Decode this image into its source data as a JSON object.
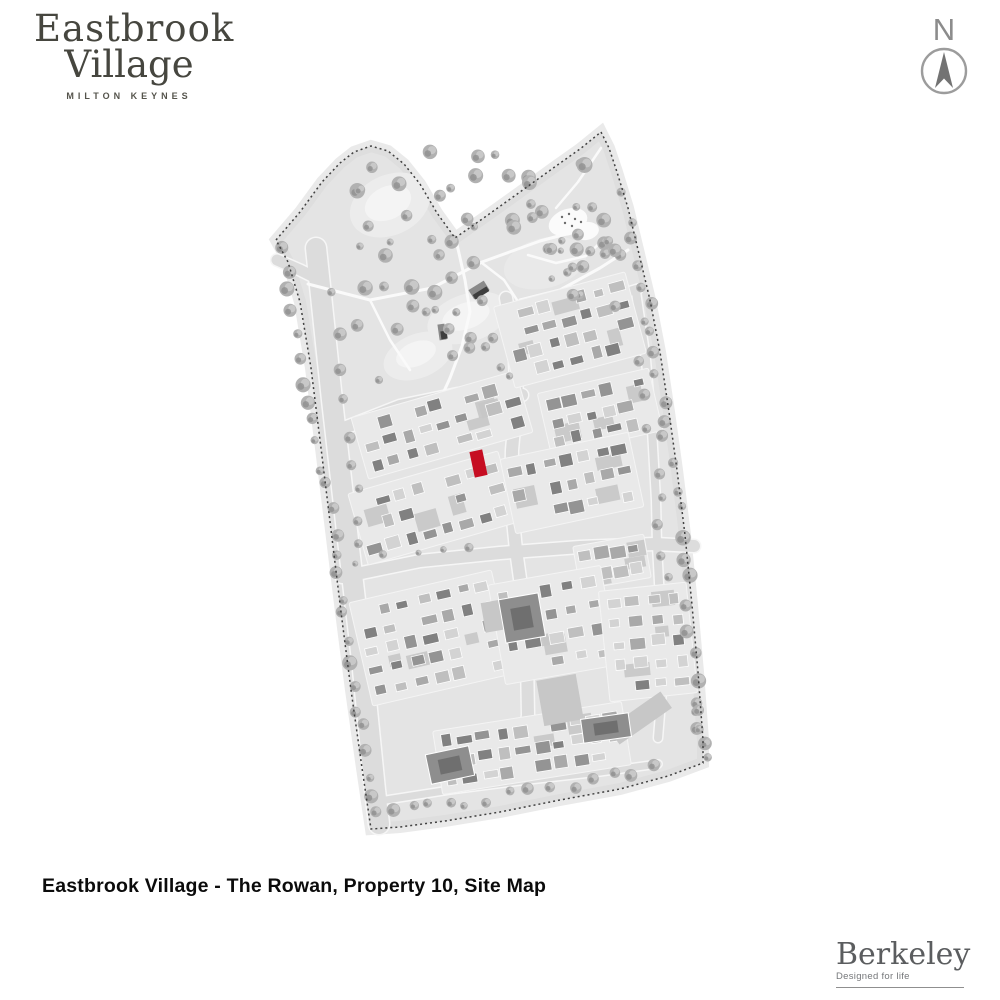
{
  "branding": {
    "site_logo": {
      "line1": "Eastbrook",
      "line2": "Village",
      "subtitle": "MILTON KEYNES",
      "color": "#46463f"
    },
    "developer_logo": {
      "name": "Berkeley",
      "tagline": "Designed for life",
      "color": "#5b5d5f"
    }
  },
  "compass": {
    "label": "N",
    "color": "#8c8c8c"
  },
  "caption": {
    "text": "Eastbrook Village - The Rowan, Property 10, Site Map"
  },
  "map": {
    "seed": 20231007,
    "colors": {
      "land": "#e4e4e4",
      "land_edge": "#d9d9d9",
      "road": "#dcdcdc",
      "road_casing": "#f6f6f6",
      "footpath": "#fafafa",
      "pond": "#ececec",
      "pond_inner": "#f4f4f4",
      "boundary": "#404040",
      "house_palette": [
        "#818181",
        "#949494",
        "#a9a9a9",
        "#bfbfbf",
        "#d3d3d3"
      ],
      "house_stroke": "#ffffff",
      "block_base": "#e9e9e9",
      "driveway": "#c7c7c7",
      "big_building": "#8e8e8e",
      "big_building_dark": "#6f6f6f",
      "tree_base": "#b1b1b1",
      "tree_light": "#cbcbcb",
      "tree_dark": "#909090",
      "bridge_dark": "#3e3e3e",
      "bridge_mid": "#8a8a8a",
      "play_area": "#fbfbfb",
      "highlight": "#c60d22"
    },
    "boundary_points": [
      [
        601,
        132
      ],
      [
        609,
        148
      ],
      [
        617,
        172
      ],
      [
        628,
        208
      ],
      [
        640,
        258
      ],
      [
        650,
        300
      ],
      [
        660,
        352
      ],
      [
        669,
        412
      ],
      [
        677,
        470
      ],
      [
        685,
        535
      ],
      [
        692,
        605
      ],
      [
        698,
        672
      ],
      [
        703,
        740
      ],
      [
        703,
        763
      ],
      [
        668,
        776
      ],
      [
        620,
        789
      ],
      [
        560,
        800
      ],
      [
        500,
        812
      ],
      [
        445,
        821
      ],
      [
        400,
        827
      ],
      [
        371,
        829
      ],
      [
        362,
        768
      ],
      [
        351,
        690
      ],
      [
        341,
        612
      ],
      [
        331,
        530
      ],
      [
        321,
        448
      ],
      [
        311,
        368
      ],
      [
        300,
        302
      ],
      [
        288,
        262
      ],
      [
        276,
        240
      ],
      [
        300,
        212
      ],
      [
        322,
        182
      ],
      [
        340,
        163
      ],
      [
        354,
        152
      ],
      [
        371,
        146
      ],
      [
        388,
        151
      ],
      [
        404,
        164
      ],
      [
        420,
        184
      ],
      [
        437,
        213
      ],
      [
        455,
        238
      ],
      [
        485,
        217
      ],
      [
        520,
        192
      ],
      [
        556,
        166
      ],
      [
        580,
        149
      ],
      [
        601,
        132
      ]
    ],
    "ponds": [
      [
        390,
        205,
        42,
        30,
        -25
      ],
      [
        468,
        318,
        42,
        24,
        -18
      ],
      [
        418,
        356,
        36,
        22,
        -22
      ]
    ],
    "park_ovals": [
      [
        545,
        263,
        42,
        25,
        -15
      ],
      [
        395,
        215,
        24,
        15,
        -25
      ]
    ],
    "roads": [
      {
        "pts": [
          [
            316,
            248
          ],
          [
            332,
            400
          ],
          [
            348,
            540
          ],
          [
            362,
            660
          ],
          [
            375,
            790
          ],
          [
            379,
            824
          ]
        ],
        "w": 20
      },
      {
        "pts": [
          [
            277,
            260
          ],
          [
            300,
            270
          ],
          [
            320,
            280
          ]
        ],
        "w": 11
      },
      {
        "pts": [
          [
            344,
            428
          ],
          [
            400,
            406
          ],
          [
            458,
            394
          ],
          [
            506,
            391
          ],
          [
            522,
            395
          ]
        ],
        "w": 12
      },
      {
        "pts": [
          [
            362,
            502
          ],
          [
            420,
            482
          ],
          [
            470,
            471
          ],
          [
            508,
            469
          ]
        ],
        "w": 8
      },
      {
        "pts": [
          [
            506,
            298
          ],
          [
            514,
            345
          ],
          [
            517,
            395
          ],
          [
            512,
            450
          ],
          [
            511,
            500
          ],
          [
            516,
            550
          ],
          [
            523,
            600
          ],
          [
            527,
            660
          ],
          [
            528,
            715
          ],
          [
            522,
            762
          ]
        ],
        "w": 12
      },
      {
        "pts": [
          [
            517,
            333
          ],
          [
            560,
            316
          ],
          [
            608,
            298
          ],
          [
            638,
            289
          ]
        ],
        "w": 9
      },
      {
        "pts": [
          [
            342,
            577
          ],
          [
            420,
            561
          ],
          [
            500,
            553
          ],
          [
            580,
            547
          ],
          [
            655,
            544
          ],
          [
            694,
            546
          ]
        ],
        "w": 12
      },
      {
        "pts": [
          [
            636,
            292
          ],
          [
            646,
            360
          ],
          [
            652,
            430
          ],
          [
            656,
            500
          ],
          [
            657,
            545
          ],
          [
            661,
            620
          ],
          [
            662,
            690
          ],
          [
            658,
            738
          ]
        ],
        "w": 8
      },
      {
        "pts": [
          [
            364,
            692
          ],
          [
            430,
            677
          ],
          [
            500,
            669
          ],
          [
            565,
            664
          ],
          [
            640,
            660
          ]
        ],
        "w": 8
      },
      {
        "pts": [
          [
            386,
            800
          ],
          [
            450,
            790
          ],
          [
            520,
            781
          ],
          [
            600,
            772
          ],
          [
            658,
            764
          ]
        ],
        "w": 7
      }
    ],
    "footpaths": [
      {
        "pts": [
          [
            308,
            284
          ],
          [
            370,
            300
          ],
          [
            432,
            288
          ],
          [
            482,
            262
          ],
          [
            540,
            241
          ],
          [
            596,
            226
          ]
        ],
        "w": 3
      },
      {
        "pts": [
          [
            456,
            240
          ],
          [
            465,
            280
          ],
          [
            470,
            312
          ],
          [
            462,
            346
          ],
          [
            450,
            378
          ],
          [
            440,
            400
          ]
        ],
        "w": 3
      },
      {
        "pts": [
          [
            482,
            263
          ],
          [
            504,
            280
          ],
          [
            517,
            300
          ]
        ],
        "w": 2.5
      },
      {
        "pts": [
          [
            601,
            148
          ],
          [
            578,
            182
          ],
          [
            556,
            208
          ]
        ],
        "w": 2.5
      },
      {
        "pts": [
          [
            528,
            255
          ],
          [
            556,
            263
          ],
          [
            586,
            256
          ],
          [
            602,
            241
          ]
        ],
        "w": 2.5
      },
      {
        "pts": [
          [
            370,
            300
          ],
          [
            390,
            340
          ],
          [
            410,
            370
          ]
        ],
        "w": 2.5
      },
      {
        "pts": [
          [
            520,
            300
          ],
          [
            560,
            290
          ],
          [
            600,
            268
          ],
          [
            628,
            250
          ]
        ],
        "w": 3
      }
    ],
    "blocks": [
      {
        "cx": 442,
        "cy": 425,
        "w": 165,
        "h": 58,
        "rot": -16,
        "nx": 9,
        "ny": 3
      },
      {
        "cx": 433,
        "cy": 508,
        "w": 150,
        "h": 68,
        "rot": -16,
        "nx": 8,
        "ny": 3
      },
      {
        "cx": 570,
        "cy": 330,
        "w": 130,
        "h": 78,
        "rot": -15,
        "nx": 7,
        "ny": 4
      },
      {
        "cx": 600,
        "cy": 412,
        "w": 108,
        "h": 58,
        "rot": -13,
        "nx": 6,
        "ny": 3
      },
      {
        "cx": 572,
        "cy": 483,
        "w": 125,
        "h": 70,
        "rot": -12,
        "nx": 7,
        "ny": 3
      },
      {
        "cx": 612,
        "cy": 562,
        "w": 66,
        "h": 38,
        "rot": -10,
        "nx": 4,
        "ny": 2
      },
      {
        "cx": 432,
        "cy": 638,
        "w": 140,
        "h": 100,
        "rot": -13,
        "nx": 7,
        "ny": 5
      },
      {
        "cx": 553,
        "cy": 625,
        "w": 108,
        "h": 95,
        "rot": -10,
        "nx": 5,
        "ny": 4
      },
      {
        "cx": 648,
        "cy": 642,
        "w": 82,
        "h": 105,
        "rot": -6,
        "nx": 4,
        "ny": 5
      },
      {
        "cx": 532,
        "cy": 748,
        "w": 185,
        "h": 58,
        "rot": -9,
        "nx": 10,
        "ny": 3
      }
    ],
    "big_buildings": [
      {
        "cx": 522,
        "cy": 618,
        "w": 40,
        "h": 44,
        "rot": -10
      },
      {
        "cx": 450,
        "cy": 765,
        "w": 44,
        "h": 30,
        "rot": -12
      },
      {
        "cx": 606,
        "cy": 728,
        "w": 48,
        "h": 24,
        "rot": -8
      }
    ],
    "patches": [
      {
        "cx": 640,
        "cy": 718,
        "w": 64,
        "h": 20,
        "rot": -35
      },
      {
        "cx": 560,
        "cy": 700,
        "w": 40,
        "h": 46,
        "rot": -10
      },
      {
        "cx": 500,
        "cy": 615,
        "w": 34,
        "h": 30,
        "rot": -10
      }
    ],
    "bridges": [
      {
        "cx": 479,
        "cy": 290,
        "w": 18,
        "h": 11,
        "rot": -32
      },
      {
        "cx": 442,
        "cy": 332,
        "w": 7,
        "h": 16,
        "rot": -8
      }
    ],
    "play_area": {
      "blobs": [
        [
          568,
          222,
          20,
          13,
          -20
        ],
        [
          586,
          231,
          13,
          9,
          -10
        ]
      ],
      "dots": [
        [
          562,
          217
        ],
        [
          569,
          214
        ],
        [
          575,
          219
        ],
        [
          565,
          223
        ],
        [
          572,
          226
        ],
        [
          581,
          222
        ]
      ]
    },
    "tree_lines": [
      {
        "pts": [
          [
            283,
            252
          ],
          [
            318,
            430
          ],
          [
            346,
            610
          ],
          [
            371,
            795
          ]
        ],
        "n": 26,
        "rmin": 4,
        "rmax": 8,
        "jit": 6
      },
      {
        "pts": [
          [
            622,
            195
          ],
          [
            655,
            360
          ],
          [
            678,
            520
          ],
          [
            698,
            700
          ],
          [
            701,
            755
          ]
        ],
        "n": 30,
        "rmin": 4,
        "rmax": 8,
        "jit": 7
      },
      {
        "pts": [
          [
            380,
            815
          ],
          [
            460,
            802
          ],
          [
            560,
            788
          ],
          [
            655,
            770
          ]
        ],
        "n": 15,
        "rmin": 3.5,
        "rmax": 7,
        "jit": 5
      },
      {
        "pts": [
          [
            333,
            295
          ],
          [
            352,
            440
          ],
          [
            363,
            545
          ]
        ],
        "n": 9,
        "rmin": 4,
        "rmax": 7,
        "jit": 5
      },
      {
        "pts": [
          [
            640,
            320
          ],
          [
            655,
            470
          ],
          [
            666,
            580
          ]
        ],
        "n": 9,
        "rmin": 4,
        "rmax": 6,
        "jit": 5
      },
      {
        "pts": [
          [
            352,
            560
          ],
          [
            420,
            553
          ],
          [
            470,
            549
          ]
        ],
        "n": 5,
        "rmin": 3,
        "rmax": 5,
        "jit": 4
      }
    ],
    "tree_scatters": [
      {
        "x": 345,
        "y": 150,
        "w": 260,
        "h": 105,
        "n": 38,
        "rmin": 3.5,
        "rmax": 8
      },
      {
        "x": 355,
        "y": 255,
        "w": 165,
        "h": 130,
        "n": 24,
        "rmin": 3.5,
        "rmax": 8
      },
      {
        "x": 520,
        "y": 240,
        "w": 110,
        "h": 70,
        "n": 14,
        "rmin": 3,
        "rmax": 7
      }
    ],
    "highlight": {
      "cx": 478.5,
      "cy": 463.5,
      "w": 13,
      "h": 26,
      "rot": -12
    }
  }
}
